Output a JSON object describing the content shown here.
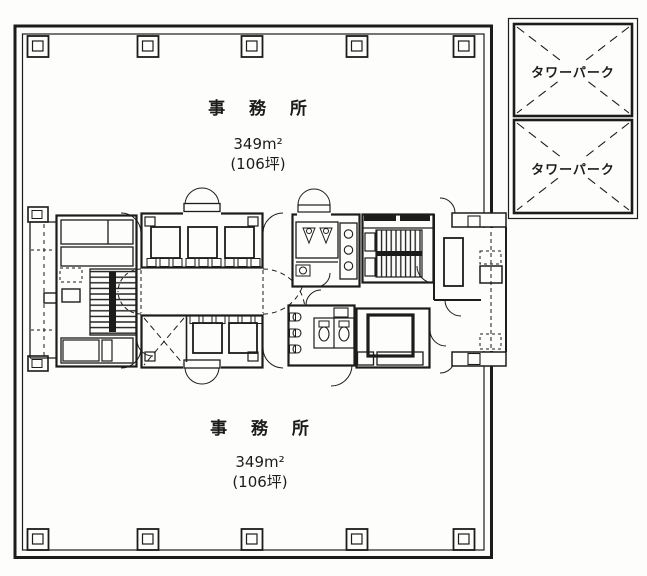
{
  "floor_plan": {
    "colors": {
      "ink": "#1c1c1c",
      "paper": "#fdfdfc"
    },
    "offices": [
      {
        "id": "top",
        "label": "事 務 所",
        "area": "349m²",
        "area_tsubo": "(106坪)"
      },
      {
        "id": "bottom",
        "label": "事 務 所",
        "area": "349m²",
        "area_tsubo": "(106坪)"
      }
    ],
    "tower_parks": [
      {
        "label": "タワーパーク"
      },
      {
        "label": "タワーパーク"
      }
    ]
  }
}
